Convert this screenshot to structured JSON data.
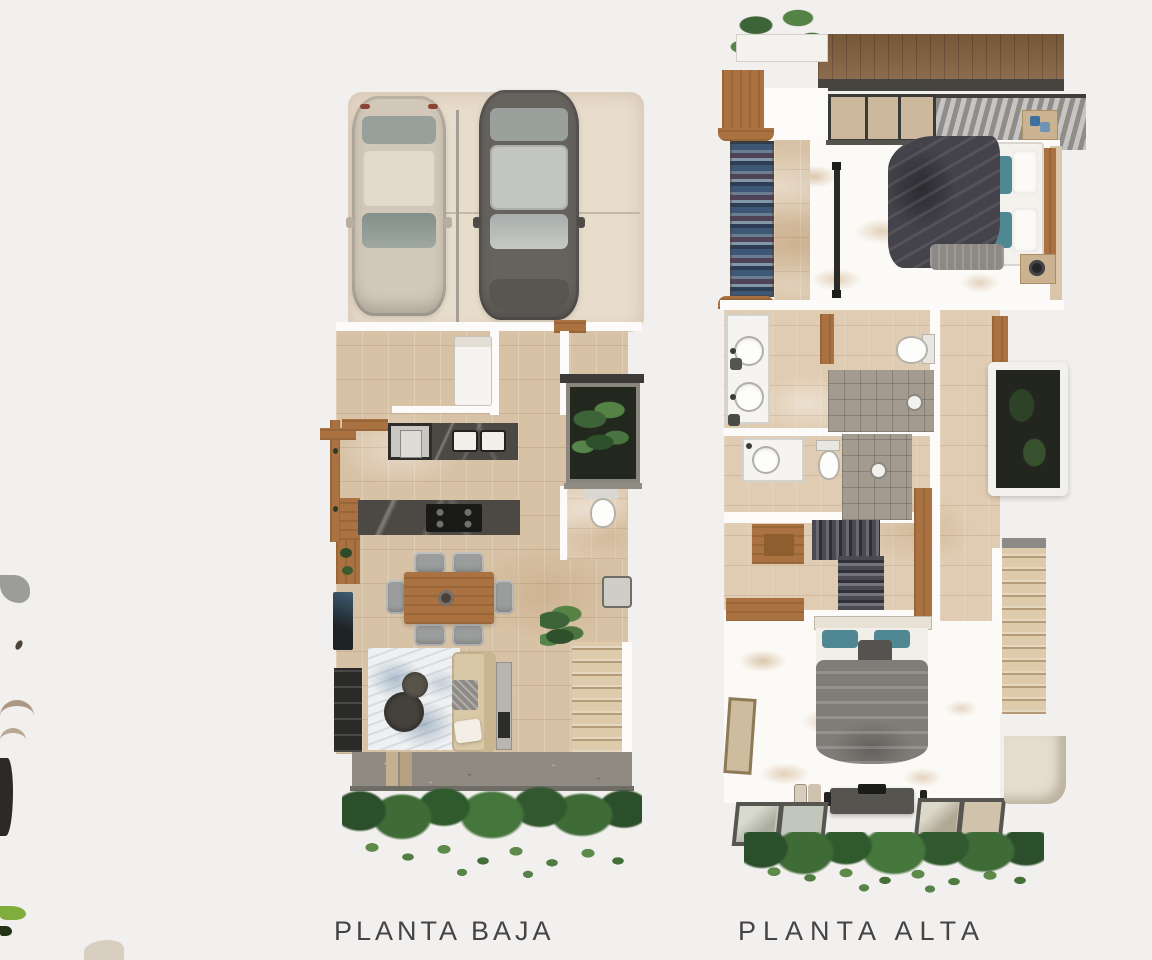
{
  "page": {
    "background_color": "#f2f0ee",
    "description_left": "ground floor plan rendering",
    "description_right": "upper floor plan rendering"
  },
  "figures": {
    "planta_baja": {
      "label": "PLANTA BAJA"
    },
    "planta_alta": {
      "label": "PLANTA ALTA"
    }
  },
  "palette": {
    "floor_tile": "#d8c2a5",
    "bath_tile": "#e0ccb2",
    "wall_white": "#fcfbf9",
    "wood_accent": "#aa7240",
    "dark_marble": "#4c4843",
    "shower_stone": "#a39b8f",
    "foliage_green": "#3f6b37",
    "car_beige": "#d2c8b9",
    "car_gray": "#66625e",
    "duvet_dark": "#44424a",
    "duvet_gray": "#807d78",
    "pillow_teal": "#4f8792",
    "label_text": "#454444"
  }
}
